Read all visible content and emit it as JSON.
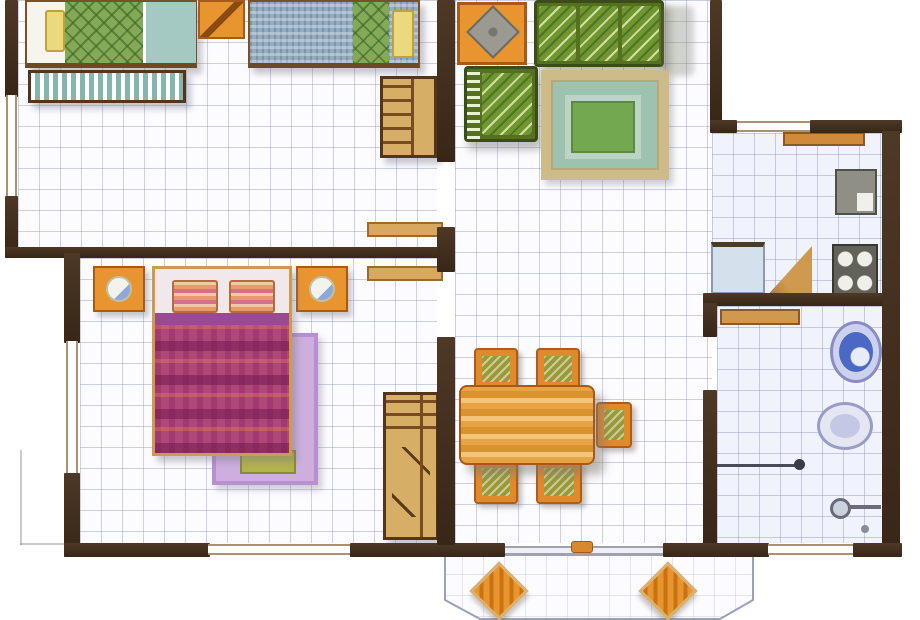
{
  "plan": {
    "type": "residential-floor-plan",
    "style": "hand-colored watercolor architectural drawing, top-down",
    "rooms": [
      {
        "name": "twin-bedroom",
        "furniture": [
          "double-bed-green-quilt",
          "yellow-pillow",
          "foot-bench-striped",
          "corner-table-orange",
          "double-bed-blue-blanket",
          "wardrobe-with-shelves"
        ]
      },
      {
        "name": "living-room",
        "furniture": [
          "side-table-with-gray-top",
          "three-seat-sofa-green",
          "armchair-green",
          "area-rug-khaki-teal",
          "coffee-table-green"
        ]
      },
      {
        "name": "master-bedroom",
        "furniture": [
          "nightstand-with-lamp-left",
          "nightstand-with-lamp-right",
          "double-bed-magenta-quilt",
          "striped-pillows",
          "lilac-rug",
          "olive-mat",
          "tall-shelf-cabinet"
        ]
      },
      {
        "name": "dining-area",
        "furniture": [
          "wood-dining-table",
          "dining-chair x5"
        ]
      },
      {
        "name": "kitchen",
        "fixtures": [
          "window-counter",
          "sink-unit",
          "four-burner-stove",
          "blue-base-counter",
          "corner-counter-triangle"
        ]
      },
      {
        "name": "bathroom",
        "fixtures": [
          "wash-basin-blue",
          "toilet",
          "shower-rod",
          "shower-head",
          "open-door-leaf"
        ]
      },
      {
        "name": "entry-porch",
        "furniture": [
          "porch-chair-left",
          "porch-chair-right"
        ],
        "features": [
          "angled-bay-outline",
          "entry-threshold",
          "door-handle"
        ]
      }
    ],
    "openings": {
      "windows": [
        "twin-bedroom-left",
        "master-bedroom-left",
        "master-bedroom-bottom",
        "kitchen-top",
        "bathroom-bottom"
      ],
      "doors": [
        "twin-bedroom-to-hall",
        "master-bedroom-to-hall",
        "bathroom-to-hall",
        "main-entry"
      ]
    },
    "palette": {
      "wall": "#42301e",
      "floor_tile": "#fcfbff",
      "floor_tile_cool": "#f0f3fb",
      "grid_line": "#7d87af",
      "wood_orange": "#e8952f",
      "wood_tan": "#d7ae66",
      "quilt_green": "#84aa58",
      "blanket_blue": "#95acc0",
      "sofa_green": "#6f9630",
      "rug_khaki": "#cdbb8a",
      "rug_teal": "#9ec2b0",
      "quilt_magenta": "#ae4878",
      "rug_lilac": "#cdaede",
      "fixture_blue": "#4a68c4",
      "pillow_yellow": "#ecd97e"
    }
  }
}
